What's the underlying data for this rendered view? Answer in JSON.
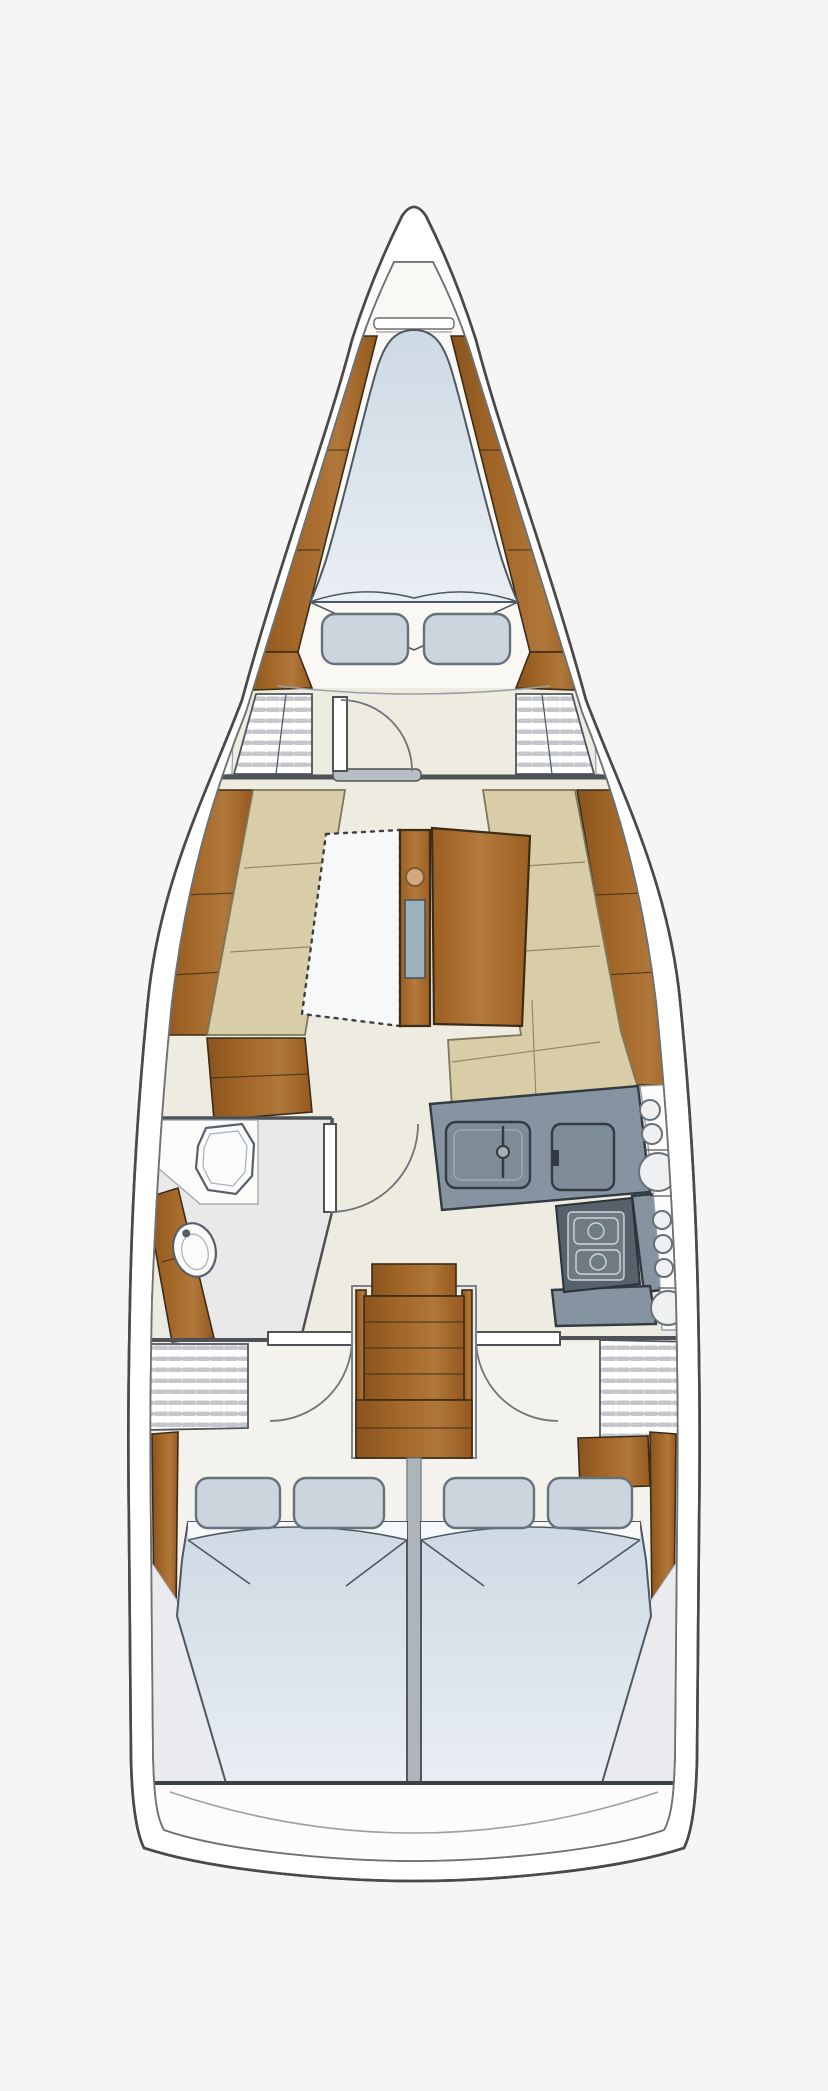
{
  "diagram": {
    "kind": "sailboat-interior-floor-plan-icon",
    "regions": [
      "bow-anchor-locker",
      "forward-cabin-v-berth",
      "wardrobe-port",
      "wardrobe-starboard",
      "salon-settees-and-table",
      "head-bathroom",
      "galley",
      "companionway-steps",
      "aft-cabin-port",
      "aft-cabin-starboard",
      "transom"
    ]
  },
  "palette": {
    "background": "#f5f5f4",
    "hull_fill": "#ffffff",
    "hull_outline": "#4a4a4a",
    "inner_line": "#707070",
    "floor_forward": "#f9f8f4",
    "floor_main": "#eeece1",
    "floor_head": "#e9e9ea",
    "floor_aft": "#f3f2ec",
    "floor_stern": "#fcfcfc",
    "wood": "#a26627",
    "wood_light": "#b0773a",
    "wood_dark": "#8a541f",
    "wood_outline": "#3a2c17",
    "table_wood": "#aa6d2f",
    "tan": "#d9cda7",
    "tan_outline": "#7c775d",
    "mattress": "#cdd9e4",
    "mattress_light": "#e9eef3",
    "mattress_sheet": "#f6f8fa",
    "bed_outline": "#4e5862",
    "pillow": "#ccd5de",
    "pillow_outline": "#66717b",
    "counter": "#8694a1",
    "counter_outline": "#323a42",
    "counter_inner": "#a5aeb6",
    "stove_body": "#57616b",
    "stove_inner": "#6e7a84",
    "stove_line": "#d0d5d9",
    "stripe": "#c3c7cb",
    "stripe_outline": "#4e565c",
    "door_stroke": "#4e5257",
    "arc_stroke": "#6f7478",
    "dash_stroke": "#3f3f3f",
    "threshold": "#b6bdc3",
    "fixture": "#fbfbfb",
    "fixture_outline": "#55606a",
    "divider": "#aeb4b9",
    "knob": "#d3a87e",
    "knob_ring": "#7a5a36",
    "bottle_slot": "#9fb0bd",
    "circle_fill": "#eef0f1",
    "circle_outline": "#667079",
    "wedge": "#e9ebee",
    "shelf_outline": "#9aa0a5"
  }
}
